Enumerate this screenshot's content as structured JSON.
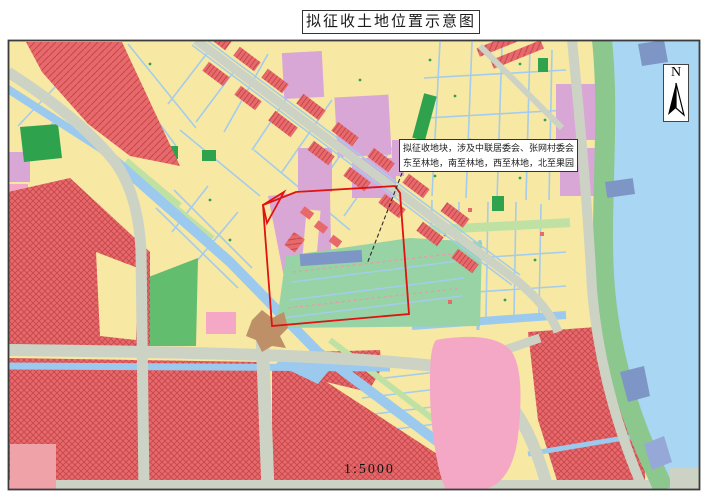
{
  "title": "拟征收土地位置示意图",
  "map": {
    "annotation": {
      "line1": "拟征收地块，涉及中联居委会、张网村委会",
      "line2": "东至林地，南至林地，西至林地，北至果园"
    },
    "north_label": "N",
    "scale_label": "1:5000"
  },
  "palette": {
    "parcel_yellow": "#F7E8A3",
    "river": "#A9D6F2",
    "canal": "#9CC9EE",
    "canal_line": "#A4CCEC",
    "red": "#E8696B",
    "red_dark": "#C4484C",
    "plum": "#D9A7D6",
    "mint": "#97D3A4",
    "green_dark": "#2FA24D",
    "green_mid": "#63BD6F",
    "green_light": "#BFE2A4",
    "green_band": "#8CC78E",
    "road": "#CDD3C4",
    "pink": "#F5A8C6",
    "pink_light": "#EFA3A8",
    "tan": "#BE9068",
    "slate": "#7E96C6",
    "periwinkle": "#96A8D8",
    "outline_red": "#E01212",
    "frame": "#3C3C3C",
    "text": "#1A1A1A"
  }
}
